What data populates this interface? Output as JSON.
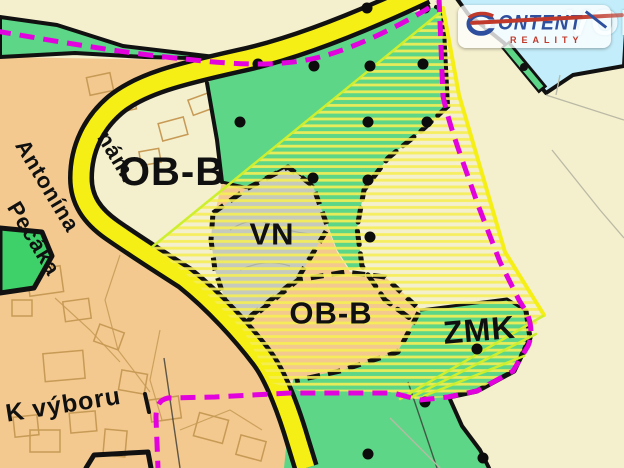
{
  "map": {
    "zone_labels": [
      {
        "id": "zone-label-ob-b-left",
        "text": "OB-B",
        "x": 172,
        "y": 172,
        "size": 40,
        "rot": 0
      },
      {
        "id": "zone-label-vn",
        "text": "VN",
        "x": 272,
        "y": 234,
        "size": 31,
        "rot": 0
      },
      {
        "id": "zone-label-ob-b-center",
        "text": "OB-B",
        "x": 331,
        "y": 313,
        "size": 31,
        "rot": 0
      },
      {
        "id": "zone-label-zmk",
        "text": "ZMK",
        "x": 478,
        "y": 333,
        "size": 32,
        "rot": -5
      }
    ],
    "street_labels": [
      {
        "id": "street-label-nam",
        "text": "nám.",
        "x": 112,
        "y": 128,
        "size": 22,
        "rot": 59
      },
      {
        "id": "street-label-antonina",
        "text": "Antonína",
        "x": 30,
        "y": 136,
        "size": 22,
        "rot": 59
      },
      {
        "id": "street-label-pecaka",
        "text": "Pecáka",
        "x": 22,
        "y": 198,
        "size": 22,
        "rot": 59
      },
      {
        "id": "street-label-k-vyboru",
        "text": "K výboru",
        "x": 4,
        "y": 402,
        "size": 25,
        "rot": -9
      }
    ],
    "orchard_dots": [
      [
        367,
        8
      ],
      [
        425,
        8
      ],
      [
        258,
        64
      ],
      [
        314,
        66
      ],
      [
        370,
        66
      ],
      [
        423,
        64
      ],
      [
        240,
        122
      ],
      [
        368,
        122
      ],
      [
        427,
        122
      ],
      [
        313,
        178
      ],
      [
        368,
        180
      ],
      [
        370,
        237
      ],
      [
        477,
        349
      ],
      [
        425,
        402
      ],
      [
        368,
        454
      ],
      [
        483,
        458
      ]
    ],
    "buildings": [
      [
        28,
        268,
        34,
        26,
        -8
      ],
      [
        64,
        300,
        26,
        20,
        -8
      ],
      [
        96,
        328,
        26,
        18,
        20
      ],
      [
        44,
        352,
        40,
        28,
        -5
      ],
      [
        120,
        372,
        26,
        20,
        10
      ],
      [
        12,
        300,
        20,
        16,
        0
      ],
      [
        150,
        398,
        30,
        22,
        -8
      ],
      [
        196,
        416,
        30,
        24,
        15
      ],
      [
        238,
        438,
        26,
        20,
        15
      ],
      [
        70,
        412,
        26,
        20,
        -5
      ],
      [
        104,
        430,
        22,
        26,
        5
      ],
      [
        30,
        430,
        30,
        22,
        0
      ],
      [
        160,
        120,
        26,
        18,
        -15
      ],
      [
        190,
        96,
        22,
        16,
        -20
      ],
      [
        140,
        150,
        20,
        14,
        -10
      ],
      [
        88,
        75,
        24,
        18,
        -12
      ],
      [
        115,
        95,
        20,
        16,
        -12
      ],
      [
        14,
        416,
        24,
        20,
        -6
      ]
    ],
    "colors": {
      "cream": "#f4efcc",
      "tan": "#f3c98f",
      "green": "#5dd687",
      "green_bright": "#3fd169",
      "blue": "#c3edfa",
      "gray_vn": "#c6cabc",
      "road_yellow": "#f5ef16",
      "hatch_yellow": "#f7ef55",
      "chartreuse": "#cdef2e",
      "magenta": "#e202dd",
      "black": "#111111",
      "building_line": "#c79a55",
      "parcel_line": "#b9b9a5"
    }
  },
  "logo": {
    "brand": "CONTENT",
    "tagline": "REALITY",
    "watermark": "VOI"
  }
}
